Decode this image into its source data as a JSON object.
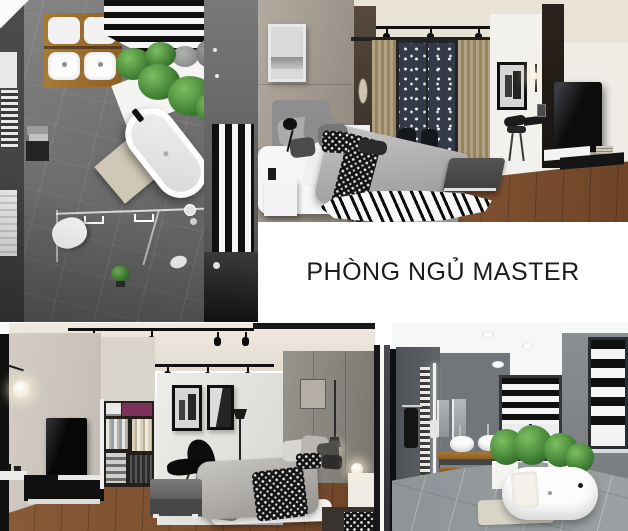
{
  "caption": {
    "text": "PHÒNG NGỦ MASTER"
  },
  "panels": {
    "bathroom_plan": {
      "name": "bathroom-top-view-render"
    },
    "bedroom_view": {
      "name": "master-bedroom-perspective-render"
    },
    "bottom_view": {
      "name": "bedroom-and-bathroom-wide-render"
    }
  },
  "colors": {
    "bg": "#ffffff",
    "caption_color": "#1c1c1c",
    "stripe_black": "#101010",
    "stripe_white": "#f5f5f5",
    "wood": "#8a5a38",
    "wood_counter": "#a87a36",
    "plant": "#3f7d33",
    "curtain": "#b3a183",
    "ceiling_cream": "#e9e3d7",
    "concrete": "#9a938b",
    "tile_gray": "#6e6e6e",
    "bath_floor": "#9ba0a3"
  }
}
